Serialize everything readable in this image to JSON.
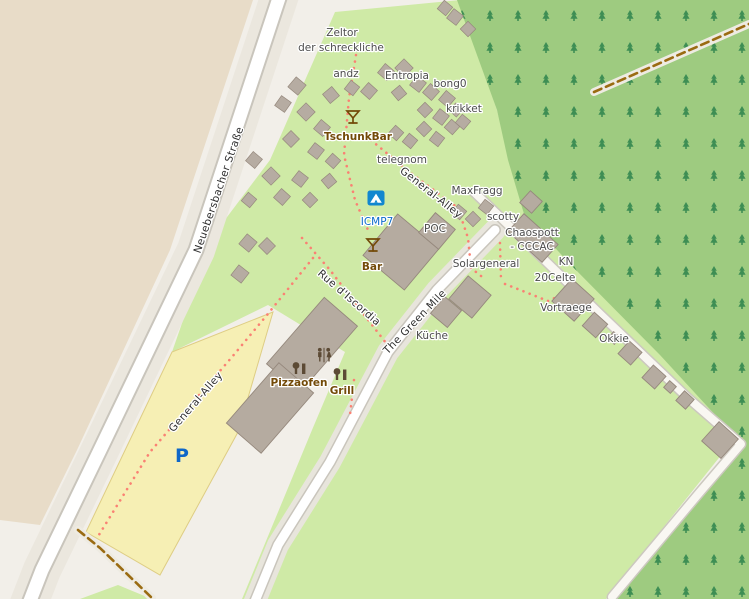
{
  "map": {
    "streets": {
      "neuebersbacher": "Neuebersbacher Straße",
      "general_alley": "General-Alley",
      "rue_discordia": "Rue d'Iscordia",
      "green_mile": "The Green Mile"
    },
    "places": {
      "zeltor1": "Zeltor",
      "zeltor2": "der schreckliche",
      "andz": "andz",
      "entropia": "Entropia",
      "bong0": "bong0",
      "krikket": "krikket",
      "telegnom": "telegnom",
      "maxfragg": "MaxFragg",
      "scotty": "scotty",
      "chaospott": "Chaospott",
      "cccac": "- CCCAC",
      "kn": "KN",
      "celte20": "20Celte",
      "poc": "POC",
      "solargeneral": "Solargeneral",
      "kueche": "Küche",
      "vortraege": "Vortraege",
      "okkie": "Okkie"
    },
    "pois": {
      "tschunkbar": "TschunkBar",
      "bar": "Bar",
      "pizzaofen": "Pizzaofen",
      "grill": "Grill",
      "icmp7": "ICMP7",
      "parking": "P"
    },
    "icons": [
      "cocktail-icon",
      "camping-icon",
      "toilets-icon",
      "bbq-oven-icon",
      "parking-p-icon",
      "conifer-tree-icon"
    ],
    "colors": {
      "background": "#f2efe9",
      "farmland": "#e8dcc8",
      "grass": "#cfeaa6",
      "forest": "#9ecb80",
      "forest_tree": "#3e8e54",
      "road_fill": "#ffffff",
      "road_casing": "#c9c5bc",
      "parking_fill": "#f6efb4",
      "parking_border": "#decd84",
      "building": "#b5aba0",
      "footpath_dotted": "#fa8173",
      "track_dashed": "#9a6b12",
      "poi_brown": "#734a08",
      "poi_blue": "#0b6acb",
      "parking_blue": "#0f67c8"
    }
  }
}
